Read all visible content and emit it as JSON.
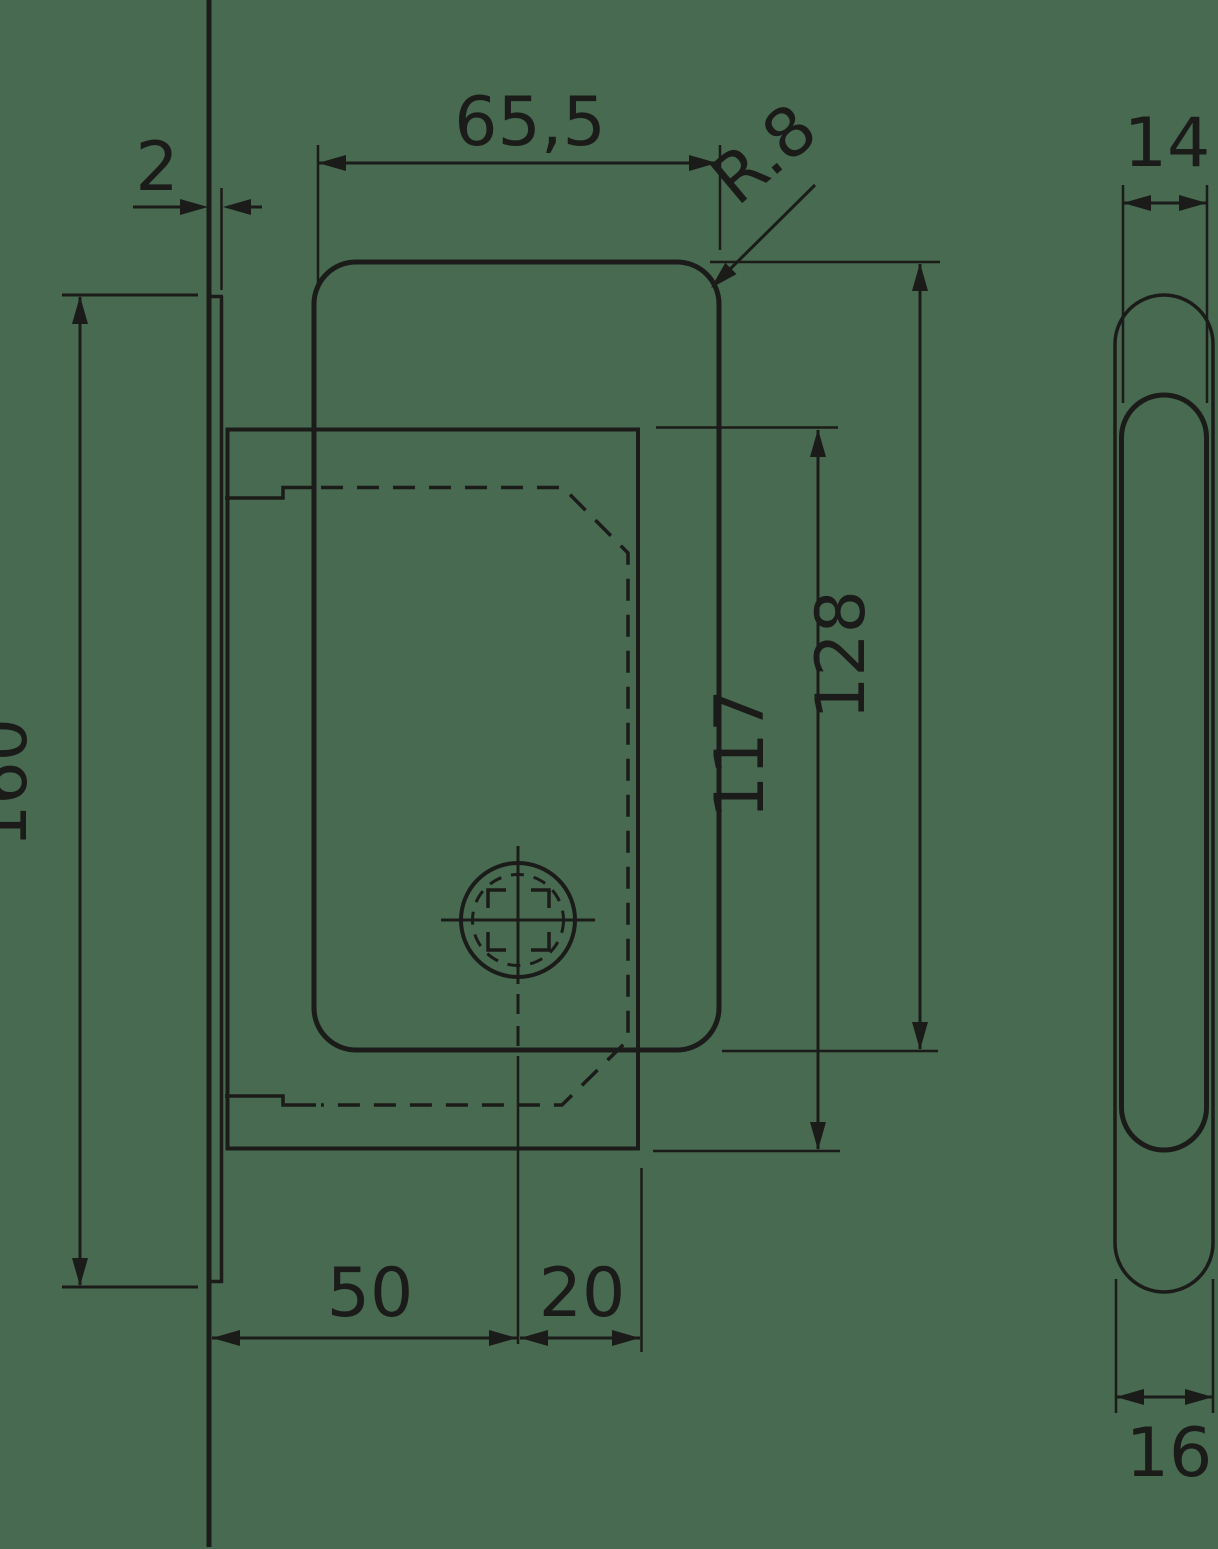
{
  "drawing_type": "technical dimension drawing - mortise lock for sliding doors",
  "colors": {
    "background": "#486A50",
    "line": "#1B1B19"
  },
  "labels": {
    "plate_thickness": "2",
    "case_width": "65,5",
    "corner_radius": "R.8",
    "plate_height": "160",
    "inner_plate_height": "117",
    "case_height": "128",
    "backset": "50",
    "spindle_offset": "20",
    "case_depth": "14",
    "plate_width": "16"
  }
}
